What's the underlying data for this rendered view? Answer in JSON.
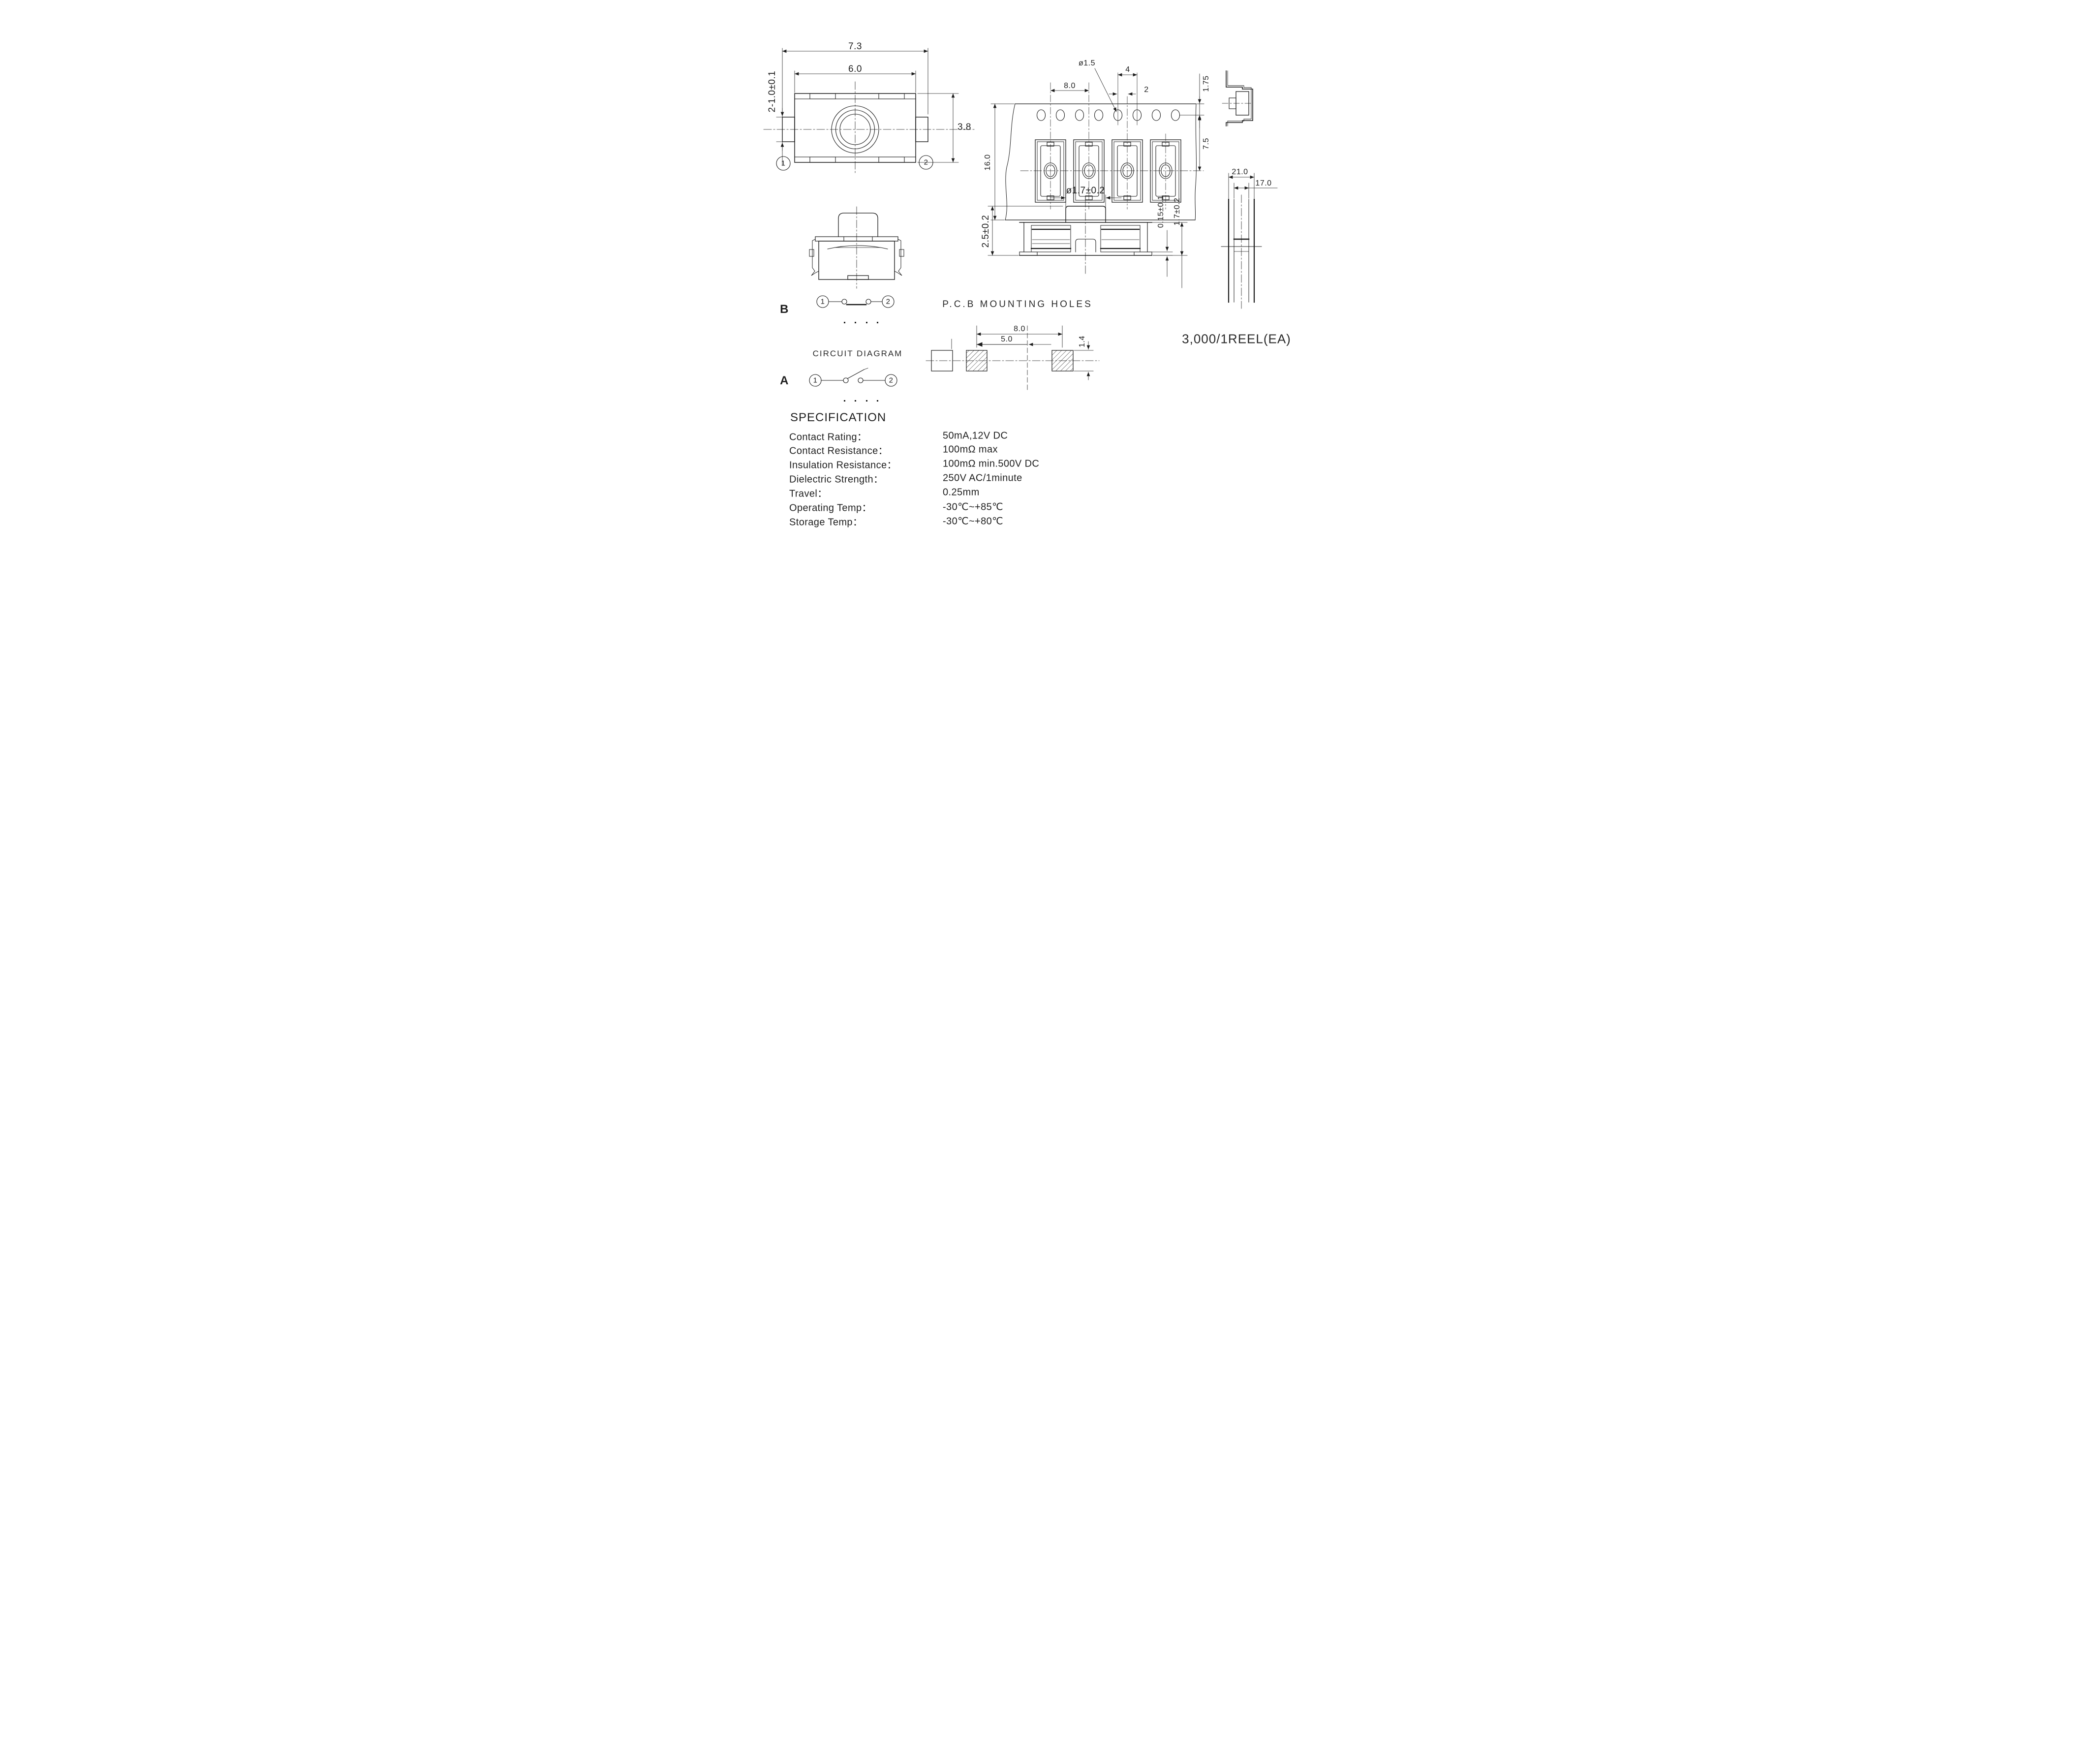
{
  "top_view": {
    "dim_width_outer": "7.3",
    "dim_width_inner": "6.0",
    "dim_height": "3.8",
    "dim_terminal": "2-1.0±0.1",
    "pin1": "1",
    "pin2": "2"
  },
  "tape_view": {
    "dim_hole_dia": "ø1.5",
    "dim_pocket_pitch": "8.0",
    "dim_hole_pitch": "4",
    "dim_offset": "2",
    "dim_edge": "1.75",
    "dim_center": "7.5",
    "dim_width": "16.0"
  },
  "section_view": {
    "dim_stem": "ø1.7±0.2",
    "dim_body": "2.5±0.2",
    "dim_standoff": "0.15±0.1",
    "dim_height": "1.7±0.2"
  },
  "reel_view": {
    "dim_outer": "21.0",
    "dim_inner": "17.0",
    "qty": "3,000/1REEL(EA)"
  },
  "pcb_view": {
    "title": "P.C.B MOUNTING HOLES",
    "dim_pitch": "8.0",
    "dim_half": "5.0",
    "dim_pad": "1.4"
  },
  "circuits": {
    "title": "CIRCUIT DIAGRAM",
    "label_b": "B",
    "label_a": "A",
    "pin1": "1",
    "pin2": "2"
  },
  "specification": {
    "title": "SPECIFICATION",
    "rows": [
      {
        "label": "Contact Rating：",
        "value": "50mA,12V DC"
      },
      {
        "label": "Contact Resistance：",
        "value": "100mΩ max"
      },
      {
        "label": "Insulation Resistance：",
        "value": "100mΩ min.500V DC"
      },
      {
        "label": "Dielectric Strength：",
        "value": "250V AC/1minute"
      },
      {
        "label": "Travel：",
        "value": "0.25mm"
      },
      {
        "label": "Operating Temp：",
        "value": "-30℃~+85℃"
      },
      {
        "label": "Storage Temp：",
        "value": "-30℃~+80℃"
      }
    ]
  }
}
